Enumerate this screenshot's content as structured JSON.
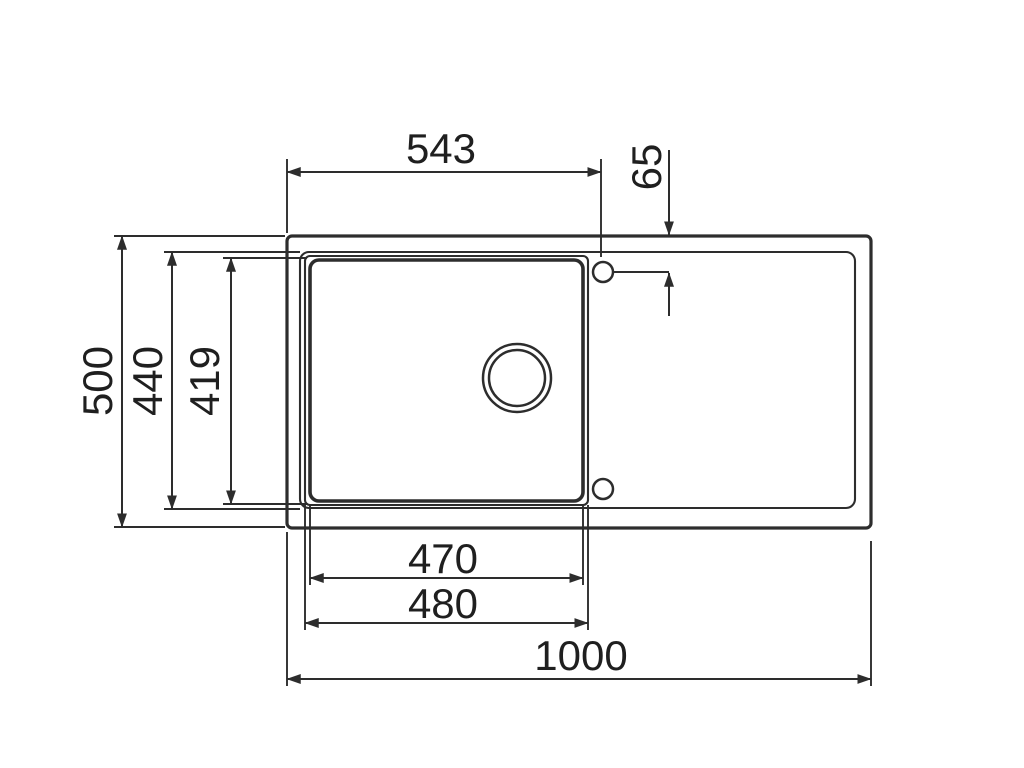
{
  "drawing": {
    "subject": "sink-top-view-dimension-drawing",
    "dimensions": {
      "hole_center_from_left": "543",
      "hole_center_from_top": "65",
      "overall_depth": "500",
      "rim_depth": "440",
      "bowl_depth": "419",
      "bowl_width_inner": "470",
      "bowl_width_outer": "480",
      "overall_width": "1000"
    },
    "colors": {
      "line": "#2d2d2d",
      "text": "#1f1f1f",
      "background": "#ffffff"
    }
  }
}
